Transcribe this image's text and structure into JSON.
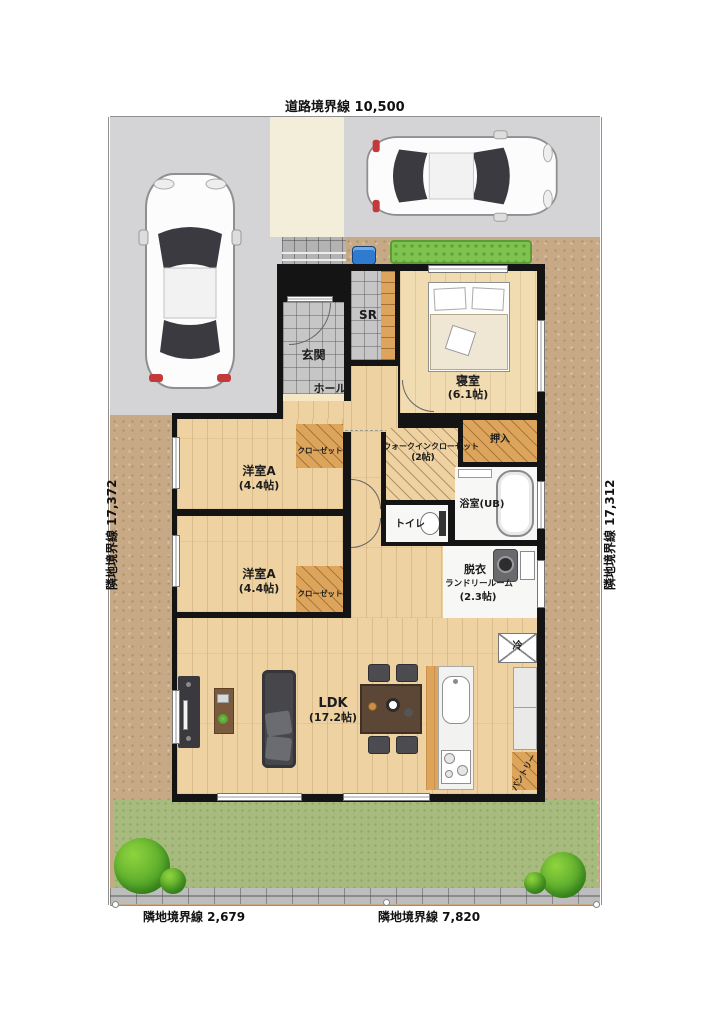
{
  "boundaries": {
    "top": "道路境界線 10,500",
    "left": "隣地境界線 17,372",
    "right": "隣地境界線 17,312",
    "bottom_left": "隣地境界線 2,679",
    "bottom_right": "隣地境界線 7,820"
  },
  "rooms": {
    "genkan": "玄関",
    "sr": "SR",
    "hall": "ホール",
    "bedroom": "寝室",
    "bedroom_size": "(6.1帖)",
    "wic": "ウォークインクローゼット",
    "wic_size": "(2帖)",
    "oshiire": "押入",
    "bath": "浴室(UB)",
    "toilet": "トイレ",
    "western1": "洋室A",
    "western1_size": "(4.4帖)",
    "closet1": "クローゼット",
    "western2": "洋室A",
    "western2_size": "(4.4帖)",
    "closet2": "クローゼット",
    "laundry_line1": "脱衣",
    "laundry_line2": "ランドリールーム",
    "laundry_size": "(2.3帖)",
    "ldk": "LDK",
    "ldk_size": "(17.2帖)",
    "fridge": "冷",
    "pantry": "パントリー"
  },
  "colors": {
    "wall": "#141414",
    "wood": "#eed2a2",
    "tile": "#c6c6c6",
    "dirt": "#c7aa85",
    "grass": "#a6bb7d",
    "hedge": "#7fc24f",
    "parking": "#d4d4d7",
    "walkway": "#f3eeda",
    "closet_wood": "#dda45c",
    "accent_blue": "#2e7bd0"
  }
}
